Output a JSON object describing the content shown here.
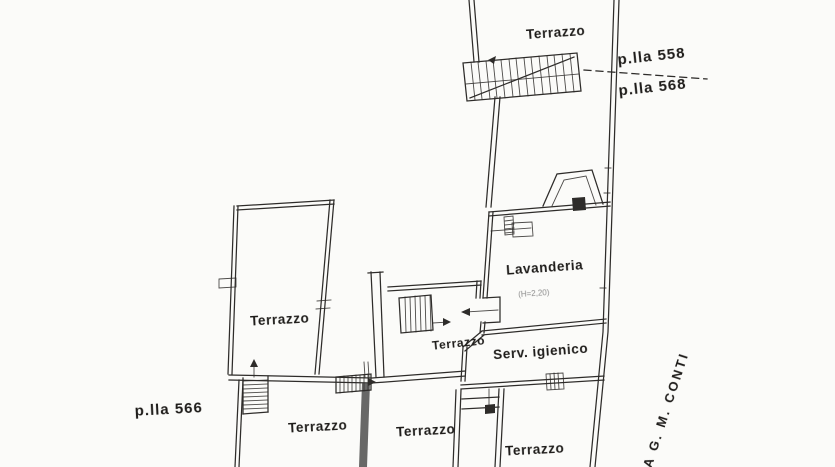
{
  "labels": {
    "terrazzo_top": "Terrazzo",
    "parcel_558": "p.lla 558",
    "parcel_568": "p.lla 568",
    "parcel_566": "p.lla 566",
    "lavanderia": "Lavanderia",
    "lavanderia_height": "(H=2,20)",
    "serv_igienico": "Serv. igienico",
    "terrazzo_left": "Terrazzo",
    "terrazzo_mid": "Terrazzo",
    "terrazzo_bottom_left": "Terrazzo",
    "terrazzo_bottom_center": "Terrazzo",
    "terrazzo_bottom_right": "Terrazzo",
    "street": "VIA G. M. CONTI"
  },
  "colors": {
    "background": "#fbfbf9",
    "line": "#2e2c2a",
    "text": "#1e1c1a",
    "faint_text": "#8a8a8a",
    "wall_fill": "#4d4d4d"
  }
}
